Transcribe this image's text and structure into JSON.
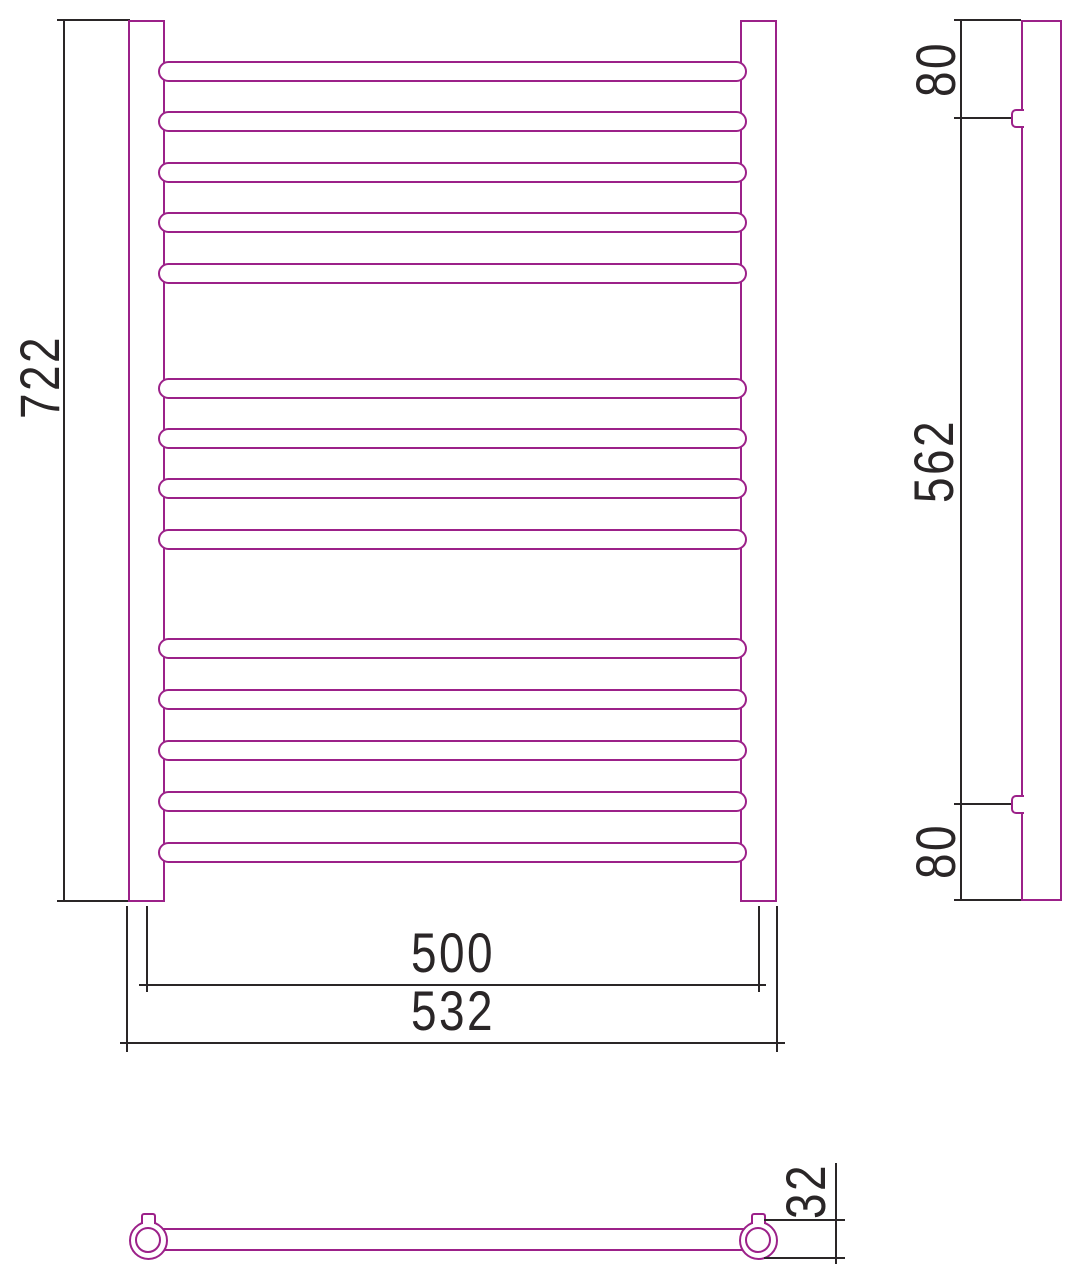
{
  "drawing": {
    "description": "Technical dimension drawing of a ladder towel rail radiator: front view, side view and bottom view",
    "colors": {
      "outline_magenta": "#9c2189",
      "dimension_ink": "#2a2627",
      "background": "#ffffff"
    }
  },
  "front_view": {
    "rail_count": 14,
    "rail_groups": [
      5,
      4,
      5
    ],
    "rail_y_centers": [
      71,
      121.5,
      172,
      222.5,
      273,
      388,
      438,
      488.5,
      539,
      648,
      699,
      750,
      801,
      852
    ],
    "dim_height": {
      "label": "722"
    },
    "dim_mount_width": {
      "label": "500"
    },
    "dim_outer_width": {
      "label": "532"
    }
  },
  "side_view": {
    "dim_top_offset": {
      "label": "80"
    },
    "dim_bracket_span": {
      "label": "562"
    },
    "dim_bottom_offset": {
      "label": "80"
    }
  },
  "bottom_view": {
    "dim_tube_diameter": {
      "label": "32"
    }
  }
}
